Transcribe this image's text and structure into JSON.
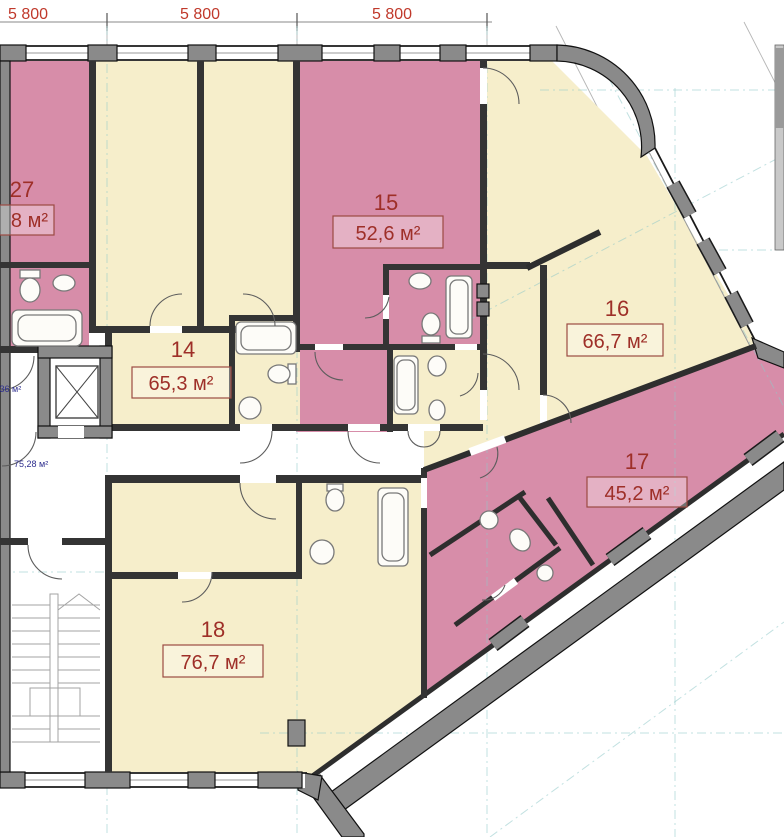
{
  "dimensions": [
    "5 800",
    "5 800",
    "5 800"
  ],
  "rooms": {
    "r27": {
      "number": "27",
      "area": "8 м²"
    },
    "r14": {
      "number": "14",
      "area": "65,3 м²"
    },
    "r15": {
      "number": "15",
      "area": "52,6 м²"
    },
    "r16": {
      "number": "16",
      "area": "66,7 м²"
    },
    "r17": {
      "number": "17",
      "area": "45,2 м²"
    },
    "r18": {
      "number": "18",
      "area": "76,7 м²"
    }
  },
  "annotations": {
    "corridor_area": "75,28 м²",
    "lobby_area": ",36 м²"
  },
  "colors": {
    "apartment_pink": "#d78da9",
    "apartment_cream": "#f6eecb",
    "wall_gray": "#8a8a8a",
    "dimension_red": "#c0392b",
    "label_red": "#9e2f28",
    "annotation_blue": "#2f2f8f",
    "grid_cyan": "#8fc9c9"
  }
}
